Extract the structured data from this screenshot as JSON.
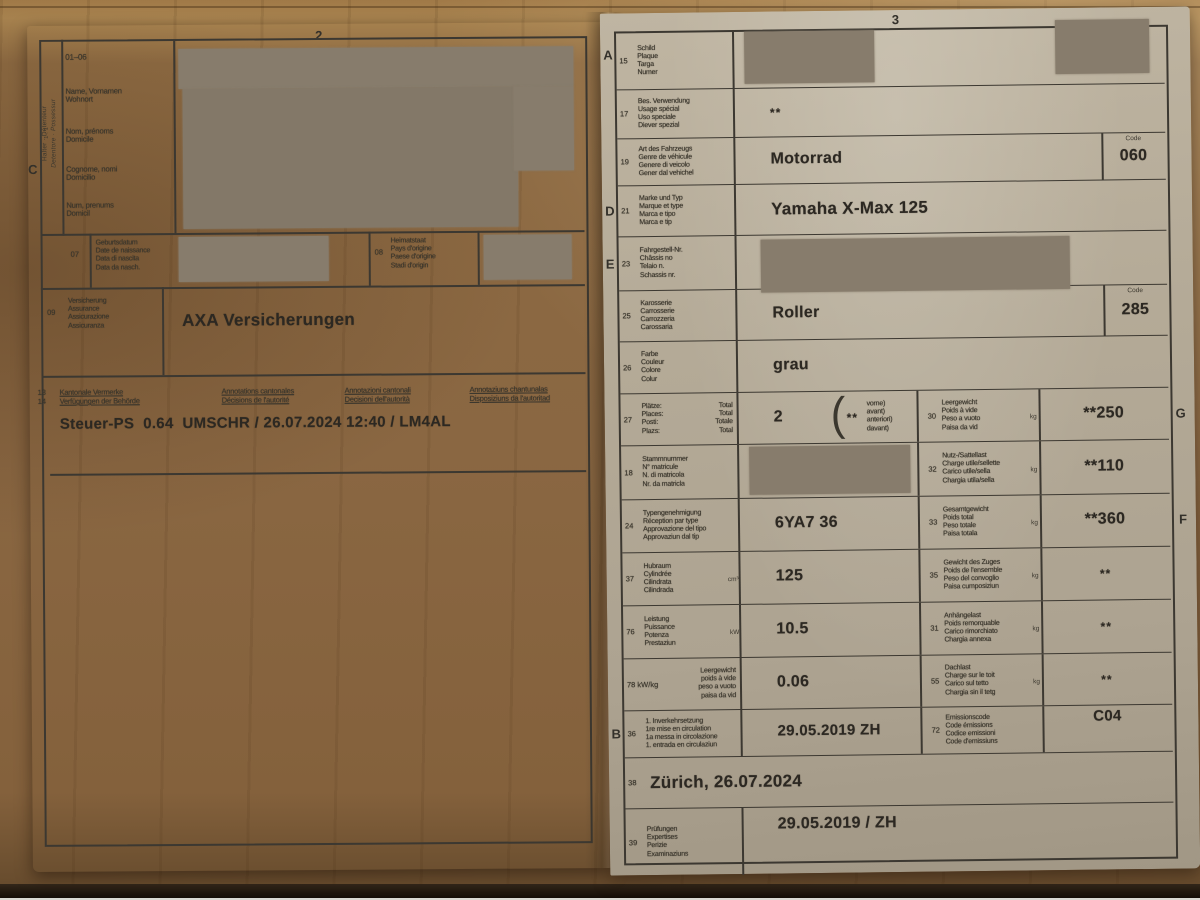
{
  "colors": {
    "paper": "#b2a896",
    "ink": "#3c3831",
    "redaction": "#877c6c",
    "wood": "#8a6742"
  },
  "page_left": {
    "page_number": "2",
    "margin_letter": "C",
    "holder_vertical": {
      "line1": "Halter · Détenteur",
      "line2": "Detentore · Possessur",
      "ratio": "1 : 1"
    },
    "field_range": "01–06",
    "holder_labels": [
      [
        "Name, Vornamen",
        "Wohnort"
      ],
      [
        "Nom, prénoms",
        "Domicile"
      ],
      [
        "Cognome, nomi",
        "Domicilio"
      ],
      [
        "Num, prenums",
        "Domicil"
      ]
    ],
    "row_07": {
      "num": "07",
      "labels": [
        "Geburtsdatum",
        "Date de naissance",
        "Data di nascita",
        "Data da nasch."
      ]
    },
    "row_08": {
      "num": "08",
      "labels": [
        "Heimatstaat",
        "Pays d'origine",
        "Paese d'origine",
        "Stadi d'origin"
      ]
    },
    "row_09": {
      "num": "09",
      "labels": [
        "Versicherung",
        "Assurance",
        "Assicurazione",
        "Assicuranza"
      ],
      "value": "AXA Versicherungen"
    },
    "remarks": {
      "num1": "13",
      "num2": "14",
      "columns": [
        [
          "Kantonale Vermerke",
          "Verfügungen der Behörde"
        ],
        [
          "Annotations cantonales",
          "Décisions de l'autorité"
        ],
        [
          "Annotazioni cantonali",
          "Decisioni dell'autorità"
        ],
        [
          "Annotaziuns chantunalas",
          "Disposiziuns da l'autoritad"
        ]
      ],
      "value": "Steuer-PS  0.64  UMSCHR / 26.07.2024 12:40 / LM4AL"
    }
  },
  "page_right": {
    "page_number": "3",
    "rows": [
      {
        "id": "15",
        "letter": "A",
        "num": "15",
        "labels": [
          "Schild",
          "Plaque",
          "Targa",
          "Numer"
        ],
        "value": ""
      },
      {
        "id": "17",
        "num": "17",
        "labels": [
          "Bes. Verwendung",
          "Usage spécial",
          "Uso speciale",
          "Diever spezial"
        ],
        "value": "**"
      },
      {
        "id": "19",
        "num": "19",
        "labels": [
          "Art des Fahrzeugs",
          "Genre de véhicule",
          "Genere di veicolo",
          "Gener dal vehichel"
        ],
        "value": "Motorrad",
        "code_label": "Code",
        "code_value": "060"
      },
      {
        "id": "21",
        "letter": "D",
        "num": "21",
        "labels": [
          "Marke und Typ",
          "Marque et type",
          "Marca e tipo",
          "Marca e tip"
        ],
        "value": "Yamaha X-Max 125"
      },
      {
        "id": "23",
        "letter": "E",
        "num": "23",
        "labels": [
          "Fahrgestell-Nr.",
          "Châssis no",
          "Telaio n.",
          "Schassis nr."
        ],
        "value": ""
      },
      {
        "id": "25",
        "num": "25",
        "labels": [
          "Karosserie",
          "Carrosserie",
          "Carrozzeria",
          "Carossaria"
        ],
        "value": "Roller",
        "code_label": "Code",
        "code_value": "285"
      },
      {
        "id": "26",
        "num": "26",
        "labels": [
          "Farbe",
          "Couleur",
          "Colore",
          "Colur"
        ],
        "value": "grau"
      },
      {
        "id": "27",
        "num": "27",
        "labels": [
          "Plätze:",
          "Places:",
          "Posti:",
          "Plazs:"
        ],
        "labels2": [
          "Total",
          "Total",
          "Totale",
          "Total"
        ],
        "value": "2",
        "bracket": {
          "stars": "**",
          "lines": [
            "vorne)",
            "avant)",
            "anteriori)",
            "davant)"
          ]
        },
        "right": {
          "num": "30",
          "labels": [
            "Leergewicht",
            "Poids à vide",
            "Peso a vuoto",
            "Paisa da vid"
          ],
          "unit": "kg",
          "value": "**250",
          "letter": "G"
        }
      },
      {
        "id": "18",
        "num": "18",
        "labels": [
          "Stammnummer",
          "N° matricule",
          "N. di matricola",
          "Nr. da matricla"
        ],
        "value": "",
        "right": {
          "num": "32",
          "labels": [
            "Nutz-/Sattellast",
            "Charge utile/sellette",
            "Carico utile/sella",
            "Chargia utila/sella"
          ],
          "unit": "kg",
          "value": "**110"
        }
      },
      {
        "id": "24",
        "num": "24",
        "labels": [
          "Typengenehmigung",
          "Réception par type",
          "Approvazione del tipo",
          "Approvaziun dal tip"
        ],
        "value": "6YA7 36",
        "right": {
          "num": "33",
          "labels": [
            "Gesamtgewicht",
            "Poids total",
            "Peso totale",
            "Paisa totala"
          ],
          "unit": "kg",
          "value": "**360",
          "letter": "F"
        }
      },
      {
        "id": "37",
        "num": "37",
        "labels": [
          "Hubraum",
          "Cylindrée",
          "Cilindrata",
          "Cilindrada"
        ],
        "unit": "cm³",
        "value": "125",
        "right": {
          "num": "35",
          "labels": [
            "Gewicht des Zuges",
            "Poids de l'ensemble",
            "Peso del convoglio",
            "Paisa cumposiziun"
          ],
          "unit": "kg",
          "value": "**"
        }
      },
      {
        "id": "76",
        "num": "76",
        "labels": [
          "Leistung",
          "Puissance",
          "Potenza",
          "Prestaziun"
        ],
        "unit": "kW",
        "value": "10.5",
        "right": {
          "num": "31",
          "labels": [
            "Anhängelast",
            "Poids remorquable",
            "Carico rimorchiato",
            "Chargia annexa"
          ],
          "unit": "kg",
          "value": "**"
        }
      },
      {
        "id": "78",
        "num": "78 kW/kg",
        "labels": [
          "Leergewicht",
          "poids à vide",
          "peso a vuoto",
          "paisa da vid"
        ],
        "labels_align": "right",
        "value": "0.06",
        "right": {
          "num": "55",
          "labels": [
            "Dachlast",
            "Charge sur le toit",
            "Carico sul tetto",
            "Chargia sin il tetg"
          ],
          "unit": "kg",
          "value": "**"
        }
      },
      {
        "id": "36",
        "letter": "B",
        "num": "36",
        "labels": [
          "1. Inverkehrsetzung",
          "1re mise en circulation",
          "1a messa in circolazione",
          "1. entrada en circulaziun"
        ],
        "value": "29.05.2019 ZH",
        "right": {
          "num": "72",
          "labels": [
            "Emissionscode",
            "Code émissions",
            "Codice emissioni",
            "Code d'emissiuns"
          ],
          "value": "C04",
          "value_top": true
        }
      },
      {
        "id": "38",
        "num": "38",
        "value": "Zürich, 26.07.2024",
        "type": "wide"
      },
      {
        "id": "39",
        "num": "39",
        "labels": [
          "Prüfungen",
          "Expertises",
          "Perizie",
          "Examinaziuns"
        ],
        "value": "29.05.2019 / ZH"
      }
    ]
  }
}
